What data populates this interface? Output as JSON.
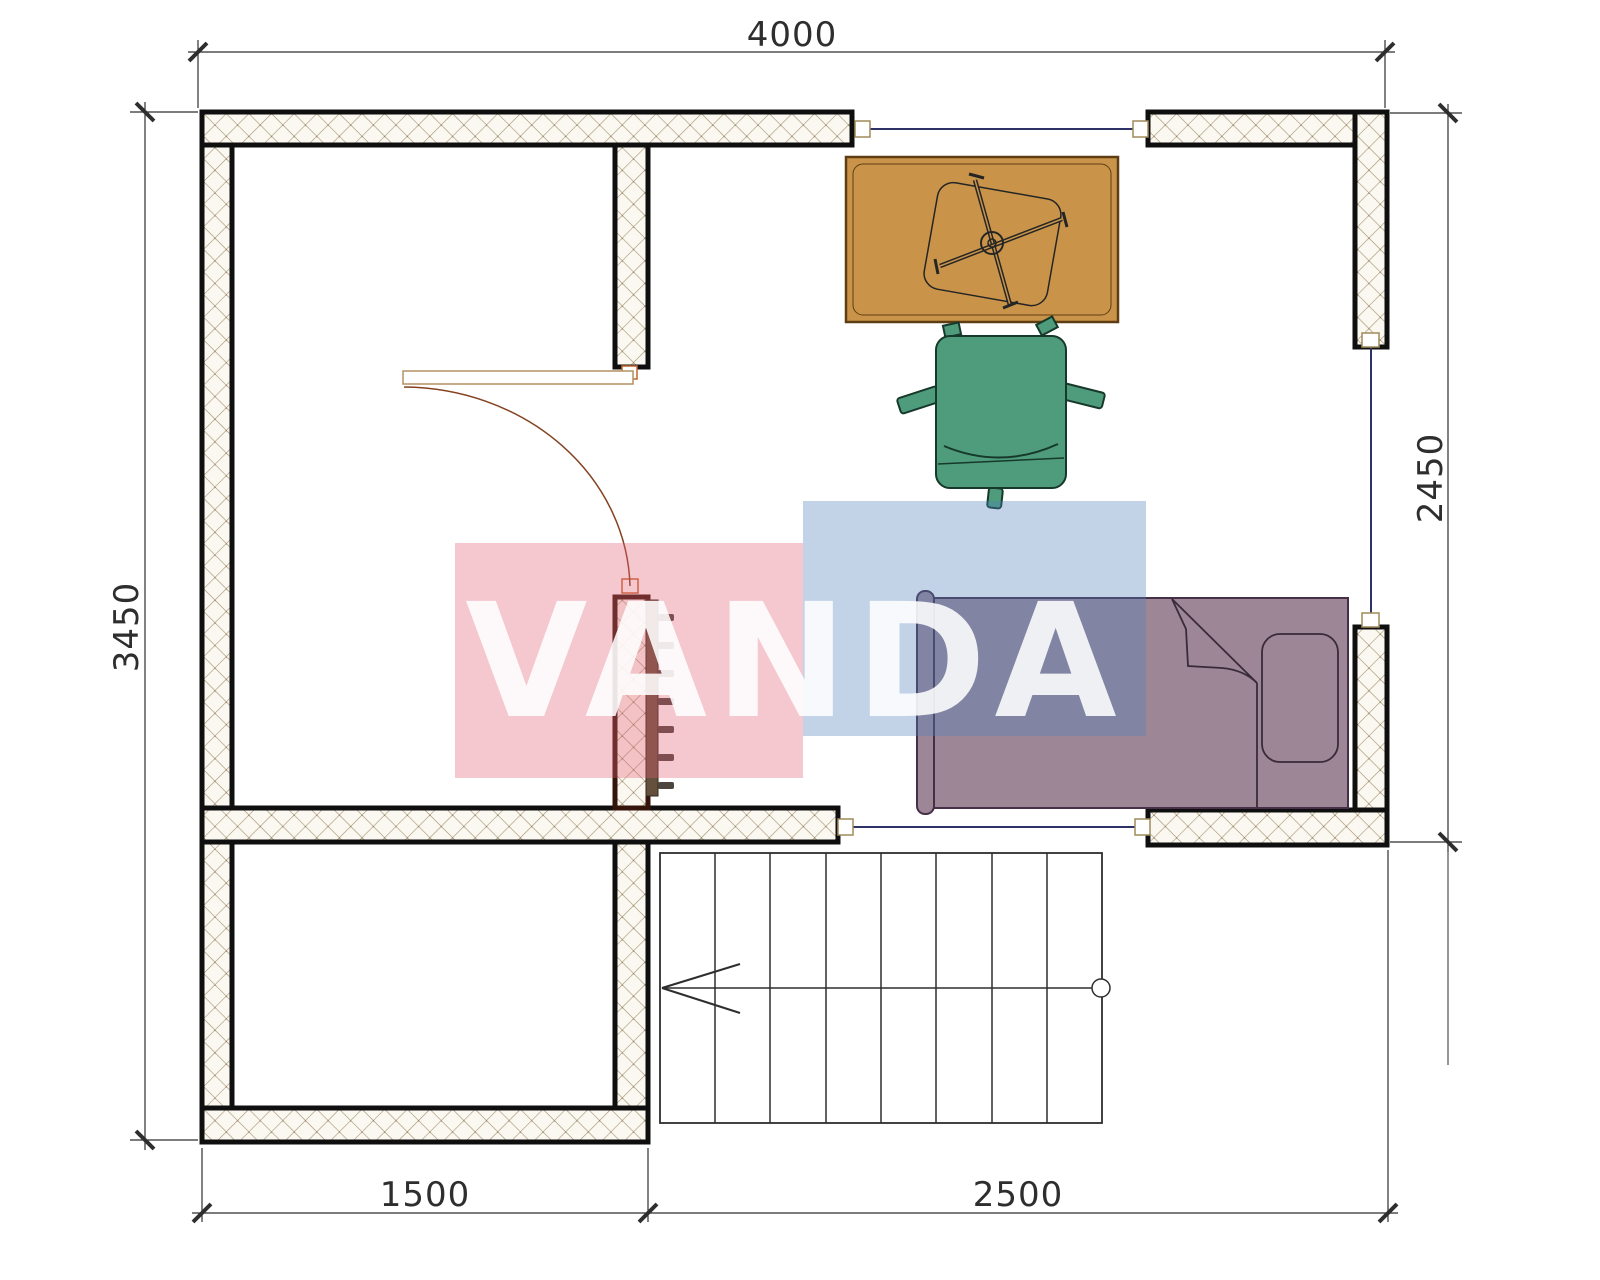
{
  "page": {
    "title": "Floor plan drawing"
  },
  "dimensions": {
    "top": "4000",
    "left": "3450",
    "right": "2450",
    "bottom_left": "1500",
    "bottom_right": "2500"
  },
  "watermark": {
    "text": "VANDA"
  },
  "colors": {
    "wall_outline": "#0f0f0f",
    "partition_outline": "#35140b",
    "hatch_line": "#a39372",
    "hatch_bg": "#fbf8f1",
    "desk": "#c9944a",
    "armchair": "#4f9c7c",
    "bed": "#9d8695",
    "radiator": "#64503c",
    "window_line": "#2d3166",
    "window_frame": "#a08a5a",
    "door_arc": "#84421f",
    "door_leaf": "#b39162",
    "dimension_text": "#2e2e2e",
    "watermark_pink": "#f6c9d0",
    "watermark_blue": "#c2d3e8"
  },
  "elements": {
    "furniture": [
      "desk",
      "office-chair",
      "armchair",
      "single-bed",
      "radiator"
    ],
    "features": [
      "door",
      "staircase",
      "window-top",
      "window-right",
      "window-bottom"
    ]
  }
}
